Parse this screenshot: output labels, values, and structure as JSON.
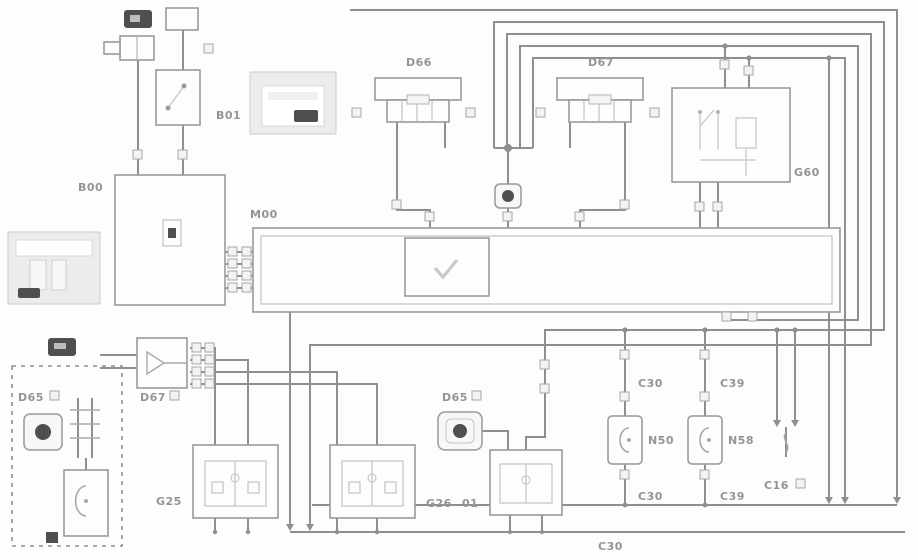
{
  "diagram": {
    "kind": "automotive-wiring-schematic",
    "labels": {
      "b00": "B00",
      "b01": "B01",
      "m00": "M00",
      "d66": "D66",
      "d67": "D67",
      "g60": "G60",
      "d67_left": "D67",
      "d65_mid": "D65",
      "d65_dash": "D65",
      "g25": "G25",
      "g26": "G26",
      "g26_sub": "01",
      "n50": "N50",
      "n58": "N58",
      "c30_top": "C30",
      "c39_top": "C39",
      "c30_bottom": "C30",
      "c39_bottom": "C39",
      "c16": "C16",
      "c30_ground": "C30"
    },
    "colors": {
      "wire": "#8f8f8f",
      "component_border": "#9a9a9a",
      "label_text": "#949494",
      "dark_badge": "#4f4f4f",
      "legend_fill": "#ececec",
      "background": "#ffffff"
    }
  }
}
